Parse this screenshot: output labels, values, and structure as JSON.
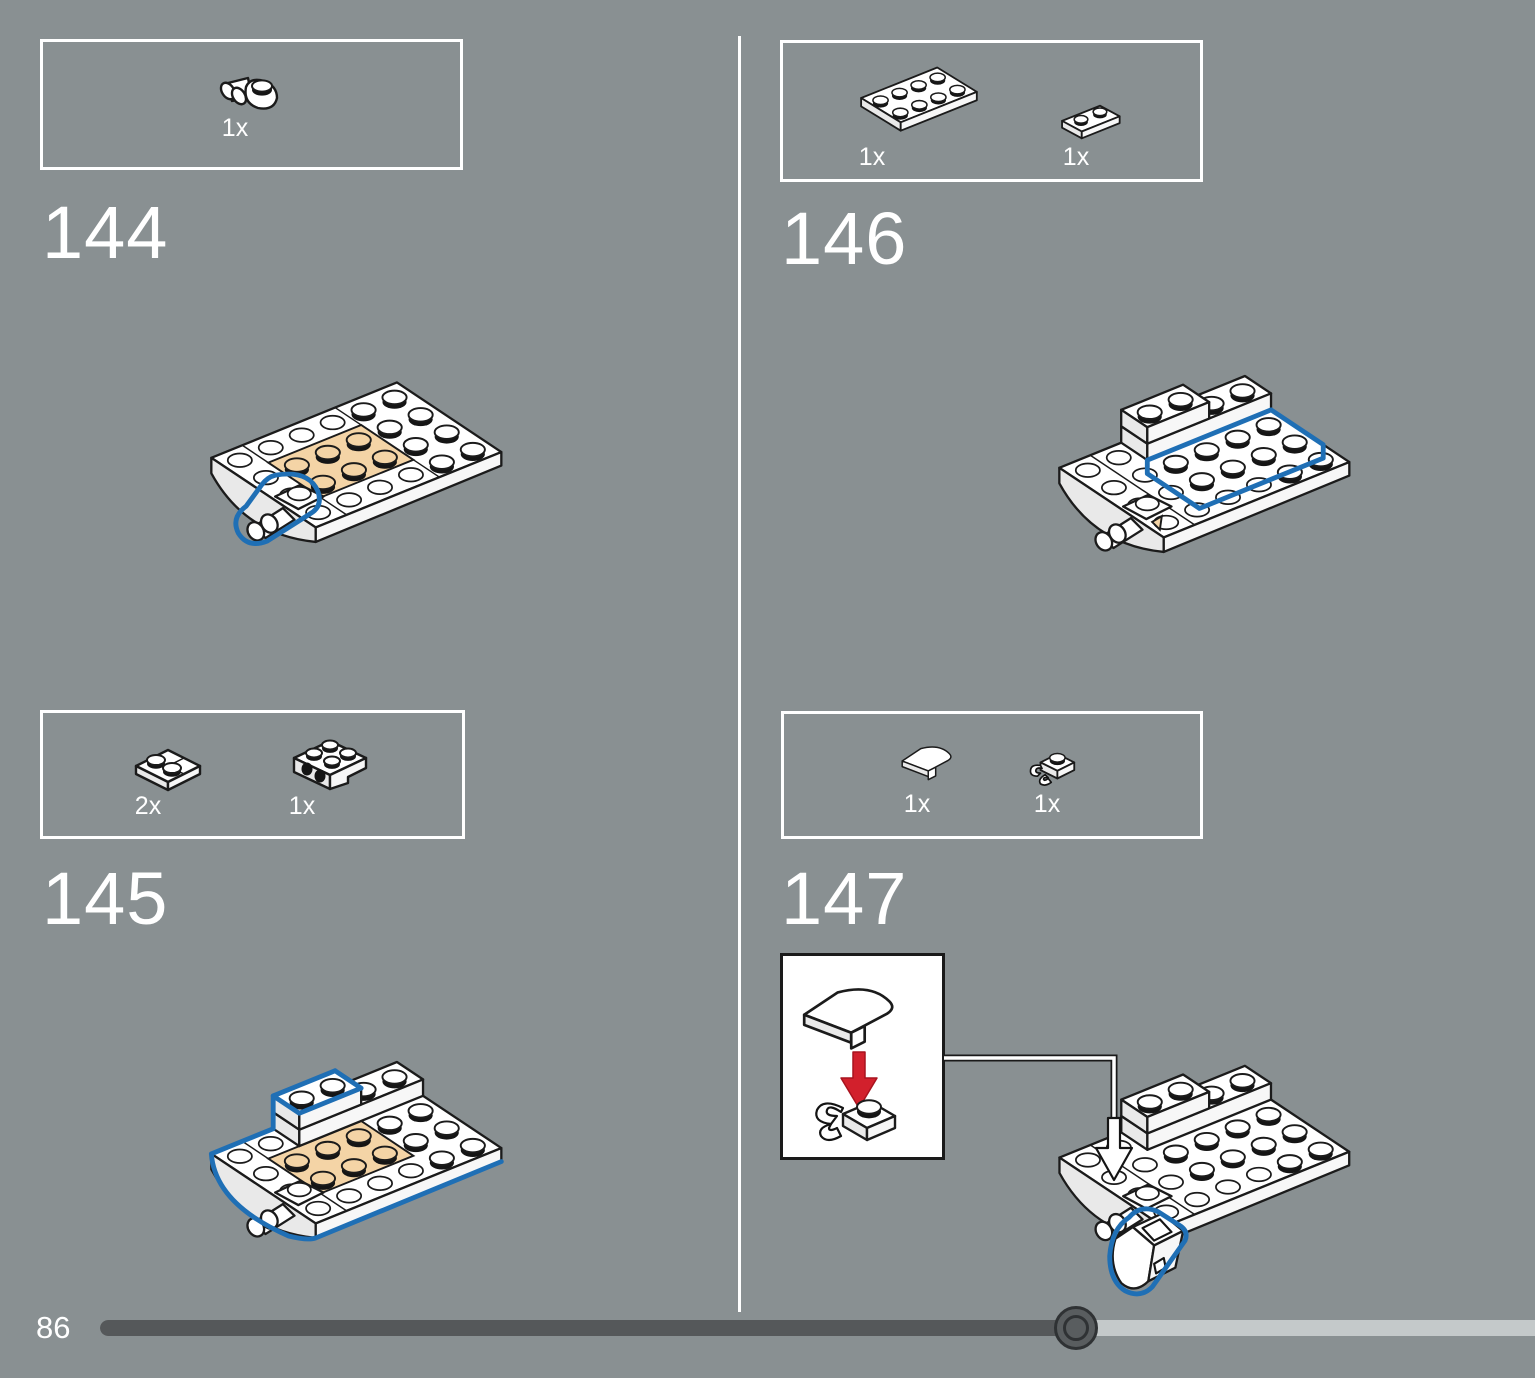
{
  "colors": {
    "background": "#899092",
    "highlight_blue": "#1f6fb5",
    "arrow_red": "#d2202c",
    "part_tan": "#f4d4a6"
  },
  "steps": [
    {
      "number": "144",
      "parts": [
        {
          "name": "plate-1x1-with-horizontal-clip",
          "count": "1x"
        }
      ]
    },
    {
      "number": "145",
      "parts": [
        {
          "name": "plate-2x2-corner",
          "count": "2x"
        },
        {
          "name": "bracket-2x2-2x2-with-side-studs",
          "count": "1x"
        }
      ]
    },
    {
      "number": "146",
      "parts": [
        {
          "name": "plate-2x4",
          "count": "1x"
        },
        {
          "name": "plate-1x2",
          "count": "1x"
        }
      ]
    },
    {
      "number": "147",
      "parts": [
        {
          "name": "slope-curved-1x2",
          "count": "1x"
        },
        {
          "name": "plate-1x1-with-vertical-clip",
          "count": "1x"
        }
      ]
    }
  ],
  "footer": {
    "page_number": "86"
  },
  "progress": {
    "fraction": 0.68,
    "track_color": "#c4c9ca",
    "fill_color": "#55585a"
  }
}
